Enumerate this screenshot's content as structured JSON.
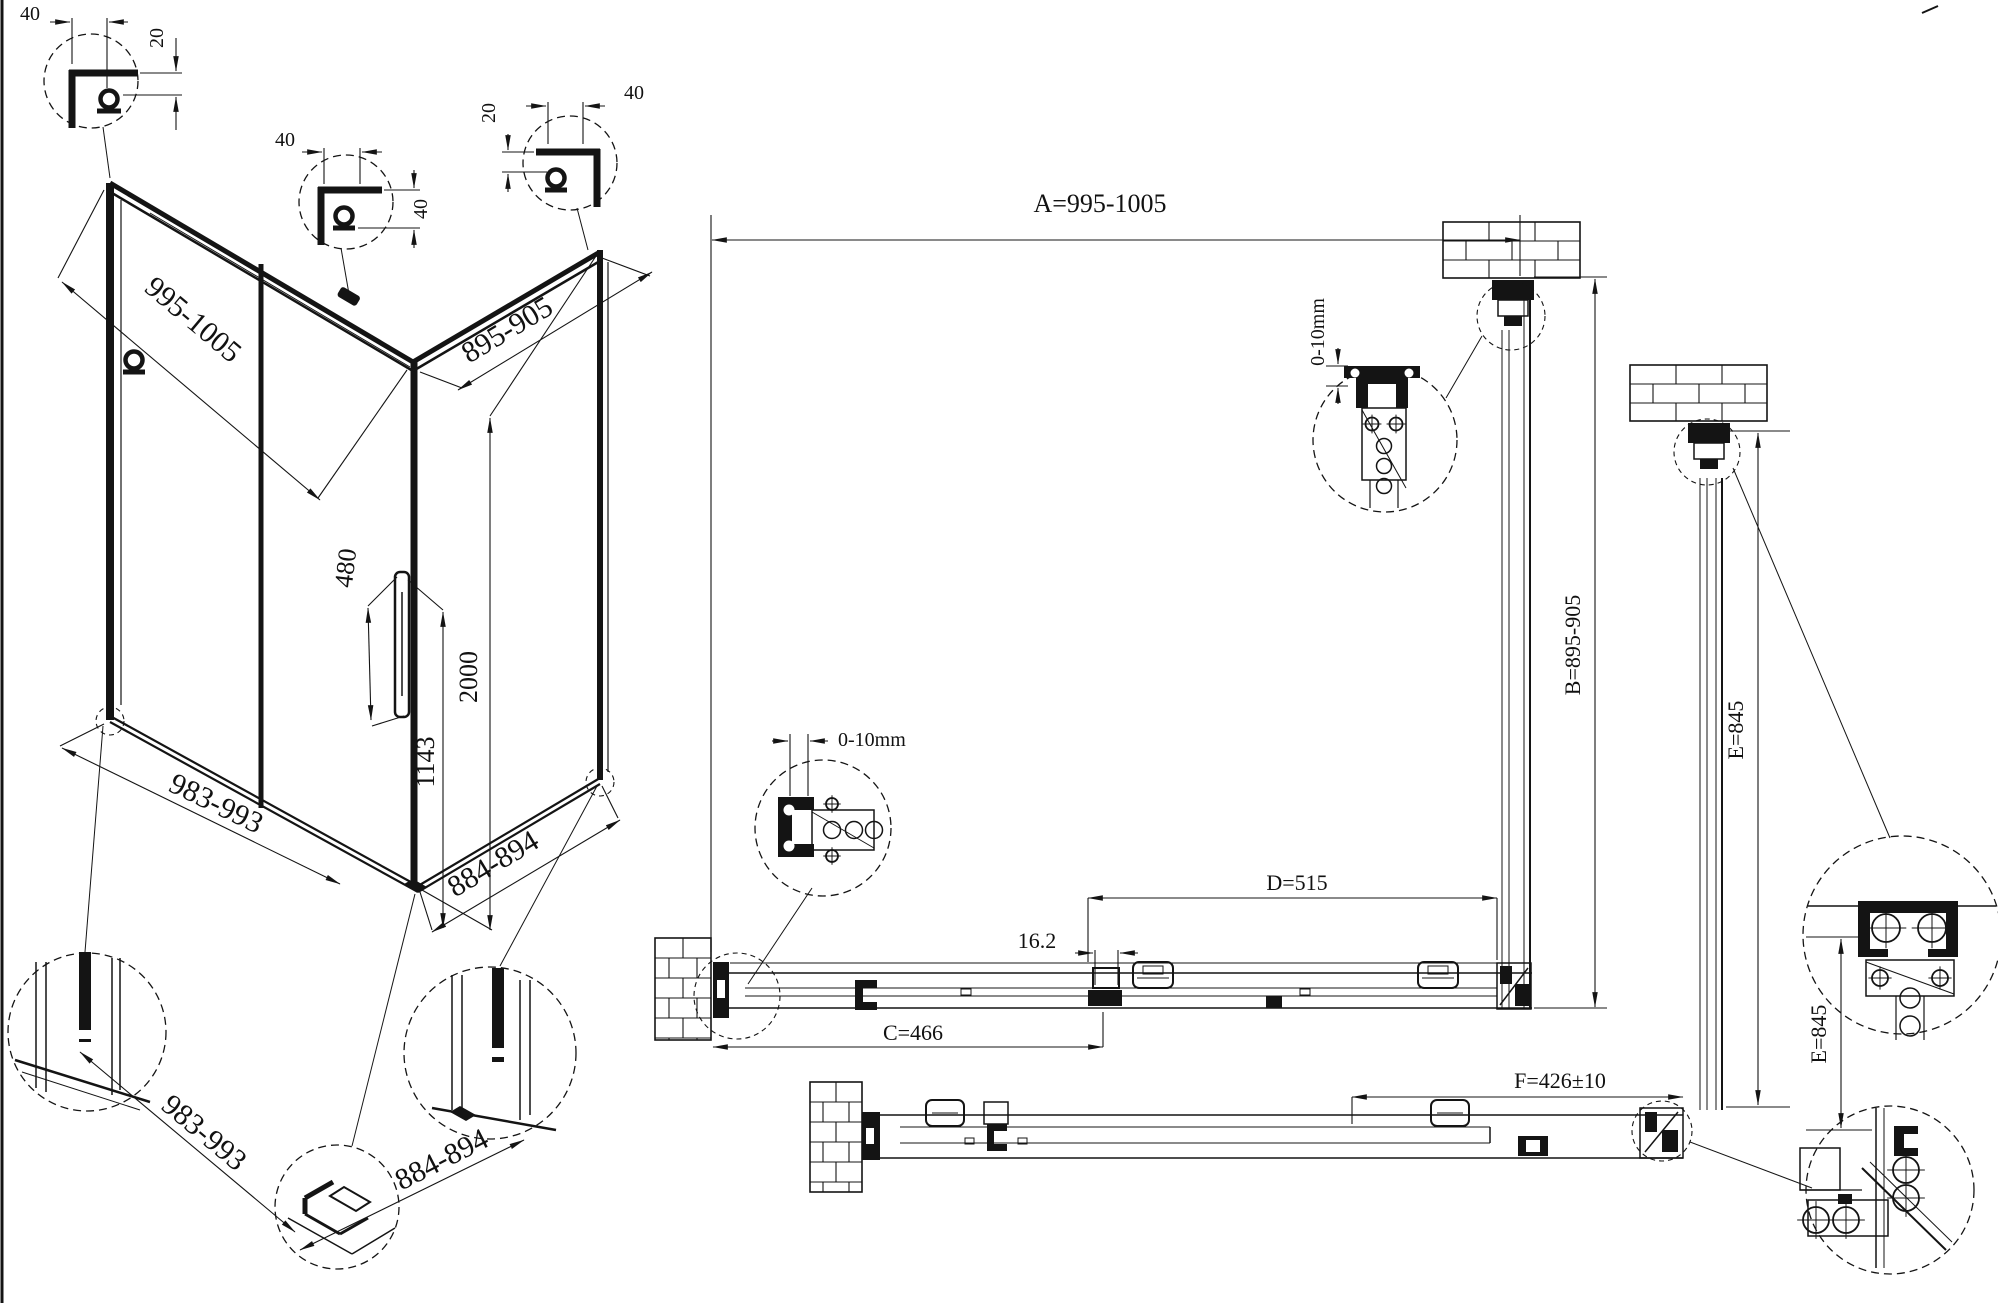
{
  "colors": {
    "background": "#ffffff",
    "line": "#141414"
  },
  "isometric": {
    "details_top": [
      {
        "width": "40",
        "height": "20"
      },
      {
        "width": "40",
        "height": "40"
      },
      {
        "width": "40",
        "height": "20"
      }
    ],
    "dims": {
      "front_width": "995-1005",
      "return_width": "895-905",
      "handle_length": "480",
      "height": "2000",
      "handle_height": "1143",
      "front_base": "983-993",
      "return_base": "884-894"
    },
    "details_bottom": {
      "front_base": "983-993",
      "return_base": "884-894"
    }
  },
  "plan": {
    "dims": {
      "a": "A=995-1005",
      "b": "B=895-905",
      "c": "C=466",
      "d": "D=515",
      "e_side": "E=845",
      "e_detail": "E=845",
      "f": "F=426±10",
      "gap": "16.2",
      "wall_adjust_top": "0-10mm",
      "wall_adjust_left": "0-10mm"
    }
  }
}
